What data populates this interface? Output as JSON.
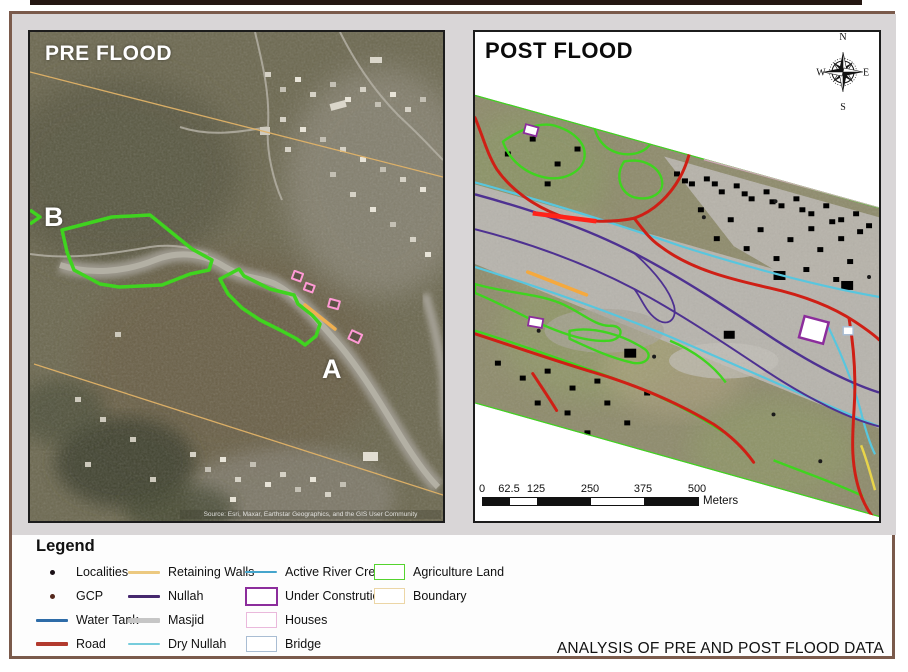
{
  "pre_flood": {
    "title": "PRE FLOOD",
    "marker_b": "B",
    "marker_a": "A",
    "attribution": "Source: Esri, Maxar, Earthstar Geographics, and the GIS User Community"
  },
  "post_flood": {
    "title": "POST FLOOD",
    "compass": {
      "north": "N",
      "east": "E",
      "south": "S",
      "west": "W"
    },
    "scalebar": {
      "ticks": [
        "0",
        "62.5",
        "125",
        "250",
        "375",
        "500"
      ],
      "unit": "Meters",
      "segment_pattern": [
        "black",
        "white",
        "black",
        "white",
        "black"
      ]
    }
  },
  "legend": {
    "title": "Legend",
    "items": [
      {
        "label": "Localities",
        "symbol": "dot",
        "color": "#1a1016"
      },
      {
        "label": "GCP",
        "symbol": "dot",
        "color": "#54281c"
      },
      {
        "label": "Water Tank",
        "symbol": "line",
        "color": "#2e6ca8"
      },
      {
        "label": "Road",
        "symbol": "line-road",
        "color": "#b23a2e"
      },
      {
        "label": "Retaining Walls",
        "symbol": "line",
        "color": "#ecc980"
      },
      {
        "label": "Nullah",
        "symbol": "line",
        "color": "#46286e"
      },
      {
        "label": "Masjid",
        "symbol": "line-thick",
        "color": "#c6c6c6"
      },
      {
        "label": "Dry Nullah",
        "symbol": "line-thin",
        "color": "#76ccdc"
      },
      {
        "label": "Active River Creek",
        "symbol": "line-thin",
        "color": "#45a5cc"
      },
      {
        "label": "Under Constrution",
        "symbol": "rect",
        "color": "#8c2d9c"
      },
      {
        "label": "Houses",
        "symbol": "rect",
        "color": "#eab9dc"
      },
      {
        "label": "Bridge",
        "symbol": "rect",
        "color": "#a9bdd3"
      },
      {
        "label": "Agriculture Land",
        "symbol": "rect",
        "color": "#55d42e"
      },
      {
        "label": "Boundary",
        "symbol": "rect",
        "color": "#ecd6a6"
      }
    ]
  },
  "footer": {
    "analysis_title": "ANALYSIS OF PRE AND POST FLOOD DATA"
  },
  "theme": {
    "frame": "#7a5a4b",
    "accent_bar": "#241712",
    "maps_area_bg": "#d9d6d7",
    "panel_border": "#1c1c1c",
    "agriculture_green": "#3fd41f",
    "road_red": "#cf1f15",
    "nullah_purple": "#4e3191",
    "creek_cyan": "#58c6de",
    "retaining_orange": "#f5a93e",
    "house_pink": "#e38ccb",
    "river_gray": "#b7b4ad"
  }
}
